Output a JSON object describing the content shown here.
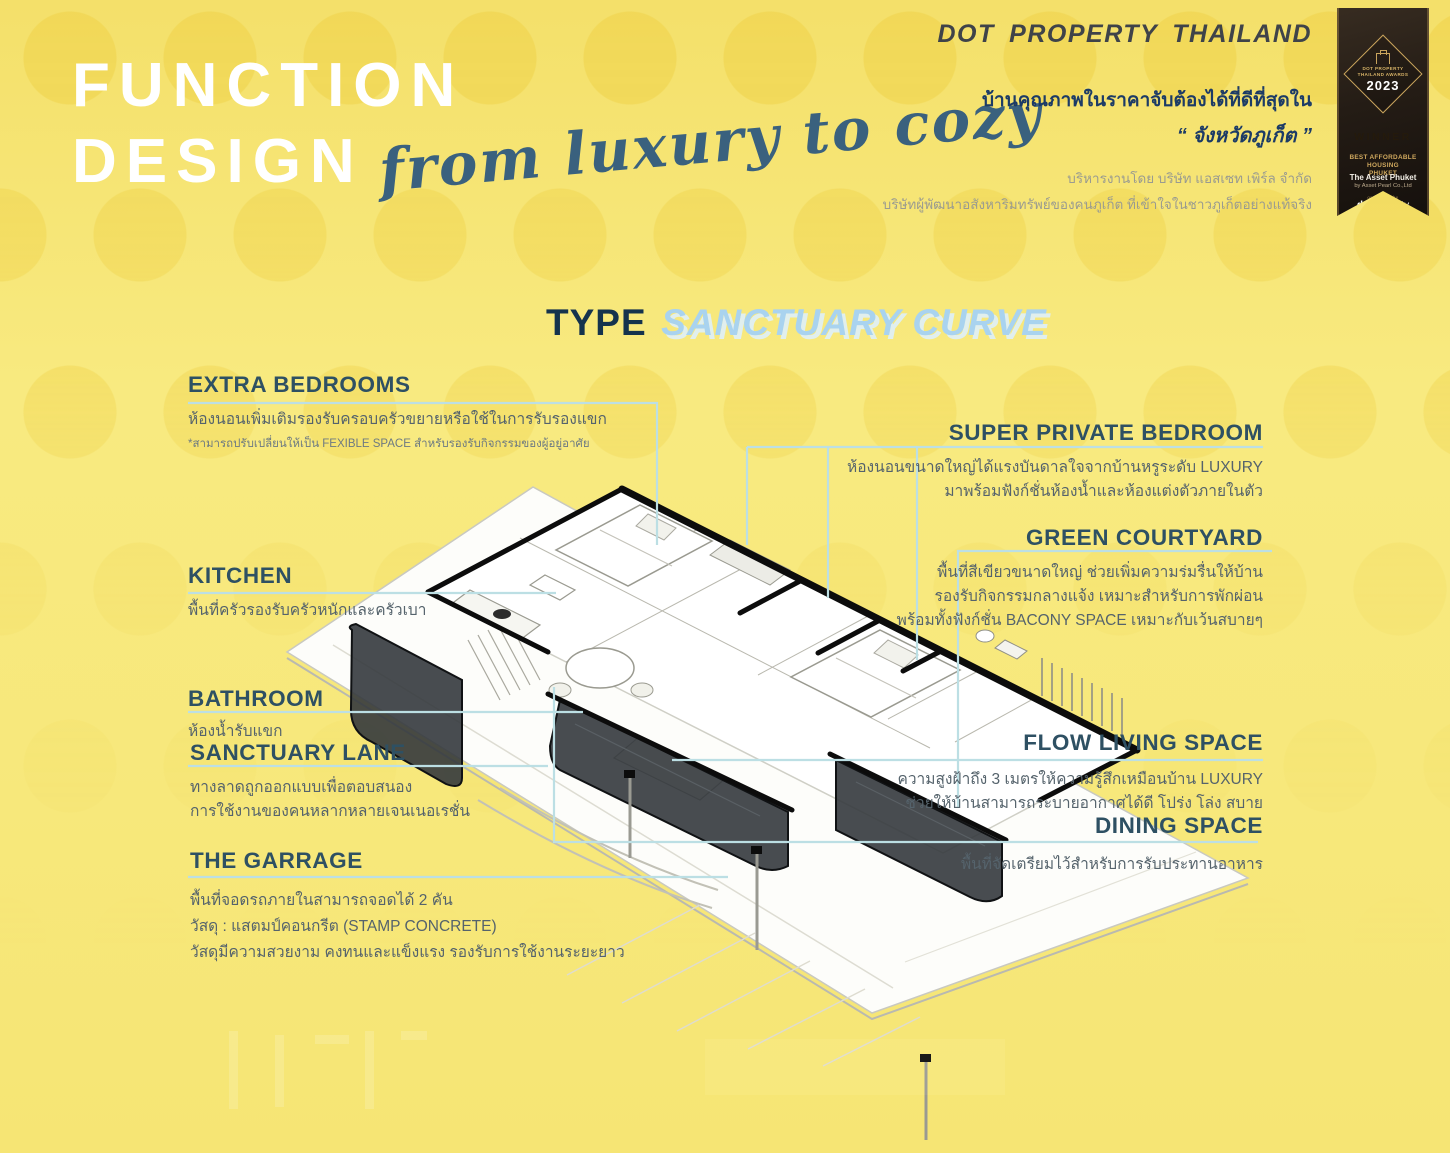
{
  "header": {
    "title_line1": "FUNCTION",
    "title_line2": "DESIGN",
    "script_text": "from luxury to cozy"
  },
  "brand": {
    "name": "DOT PROPERTY THAILAND",
    "tagline_line1": "บ้านคุณภาพในราคาจับต้องได้ที่ดีที่สุดใน",
    "tagline_line2": "“ จังหวัดภูเก็ต ”",
    "managed_by": "บริหารงานโดย บริษัท แอสเซท เพิร์ล จำกัด",
    "developer_note": "บริษัทผู้พัฒนาอสังหาริมทรัพย์ของคนภูเก็ต ที่เข้าใจในชาวภูเก็ตอย่างแท้จริง"
  },
  "award": {
    "event": "DOT PROPERTY THAILAND AWARDS",
    "year": "2023",
    "result": "WINNER",
    "category_line1": "BEST AFFORDABLE HOUSING",
    "category_line2": "PHUKET",
    "project": "The Asset Phuket",
    "company": "by Asset Pearl Co.,Ltd",
    "organizer_prefix": "organized by",
    "organizer_bold": "dot",
    "organizer_rest": "property"
  },
  "type_title": {
    "prefix": "TYPE",
    "name": "SANCTUARY CURVE"
  },
  "callouts_left": [
    {
      "title": "EXTRA BEDROOMS",
      "line1": "ห้องนอนเพิ่มเติมรองรับครอบครัวขยายหรือใช้ในการรับรองแขก",
      "note": "*สามารถปรับเปลี่ยนให้เป็น FEXIBLE SPACE สำหรับรองรับกิจกรรมของผู้อยู่อาศัย"
    },
    {
      "title": "KITCHEN",
      "line1": "พื้นที่ครัวรองรับครัวหนักและครัวเบา"
    },
    {
      "title": "BATHROOM",
      "line1": "ห้องน้ำรับแขก"
    },
    {
      "title": "SANCTUARY LANE",
      "line1": "ทางลาดถูกออกแบบเพื่อตอบสนอง",
      "line2": "การใช้งานของคนหลากหลายเจนเนอเรชั่น"
    },
    {
      "title": "THE GARRAGE",
      "line1": "พื้นที่จอดรถภายในสามารถจอดได้ 2 คัน",
      "line2": "วัสดุ : แสตมป์คอนกรีต (STAMP CONCRETE)",
      "line3": "วัสดุมีความสวยงาม คงทนและแข็งแรง รองรับการใช้งานระยะยาว"
    }
  ],
  "callouts_right": [
    {
      "title": "SUPER PRIVATE BEDROOM",
      "line1": "ห้องนอนขนาดใหญ่ได้แรงบันดาลใจจากบ้านหรูระดับ LUXURY",
      "line2": "มาพร้อมฟังก์ชั่นห้องน้ำและห้องแต่งตัวภายในตัว"
    },
    {
      "title": "GREEN COURTYARD",
      "line1": "พื้นที่สีเขียวขนาดใหญ่ ช่วยเพิ่มความร่มรื่นให้บ้าน",
      "line2": "รองรับกิจกรรมกลางแจ้ง เหมาะสำหรับการพักผ่อน",
      "line3": "พร้อมทั้งฟังก์ชั่น BACONY SPACE เหมาะกับเว้นสบายๆ"
    },
    {
      "title": "FLOW LIVING SPACE",
      "line1": "ความสูงฝ้าถึง 3 เมตรให้ความรู้สึกเหมือนบ้าน LUXURY",
      "line2": "ช่วยให้บ้านสามารถระบายอากาศได้ดี โปร่ง โล่ง สบาย"
    },
    {
      "title": "DINING SPACE",
      "line1": "พื้นที่จัดเตรียมไว้สำหรับการรับประทานอาหาร"
    }
  ],
  "colors": {
    "background_yellow": "#f7e87b",
    "callout_line_blue": "#bcdfe4",
    "heading_teal": "#2e5063",
    "type_navy": "#15334d",
    "type_light_blue": "#a9d3ef",
    "script_blue": "#3a617e",
    "brand_navy": "#1c3b66",
    "ribbon_gold": "#c9a45c"
  }
}
